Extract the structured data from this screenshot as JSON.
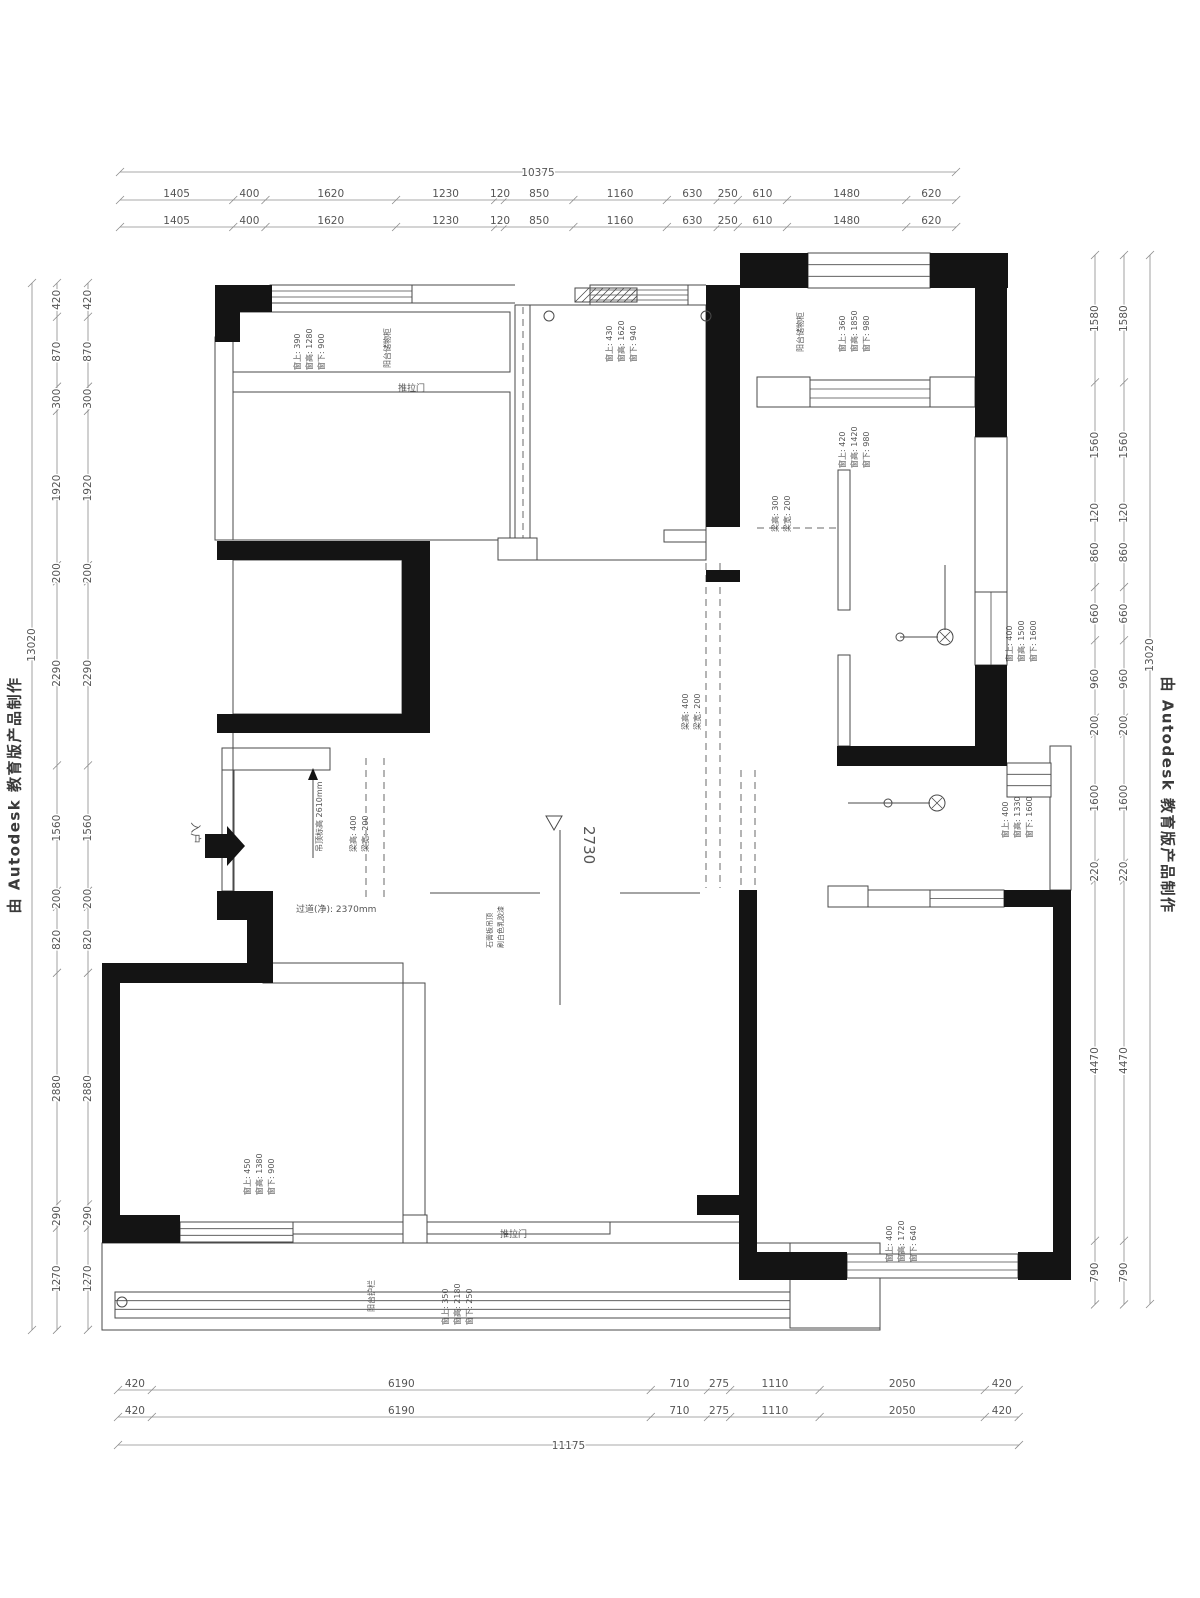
{
  "watermark": {
    "text": "由 Autodesk 教育版产品制作"
  },
  "dims": {
    "top": {
      "overall": "10375",
      "values": [
        "1405",
        "400",
        "1620",
        "1230",
        "120",
        "850",
        "1160",
        "630",
        "250",
        "610",
        "1480",
        "620"
      ]
    },
    "bottom": {
      "overall": "11175",
      "values": [
        "420",
        "6190",
        "710",
        "275",
        "1110",
        "2050",
        "420"
      ]
    },
    "left": {
      "overall": "13020",
      "values": [
        "420",
        "870",
        "300",
        "1920",
        "200",
        "2290",
        "1560",
        "200",
        "820",
        "2880",
        "290",
        "1270"
      ]
    },
    "right": {
      "overall": "13020",
      "values": [
        "1580",
        "1560",
        "120",
        "860",
        "660",
        "960",
        "200",
        "1600",
        "220",
        "4470",
        "790"
      ]
    }
  },
  "annotations": [
    {
      "name": "window-note-1",
      "x": 300,
      "y": 370,
      "rot": -90,
      "size": 8,
      "lines": [
        "窗上: 390",
        "窗高: 1280",
        "窗下: 900"
      ]
    },
    {
      "name": "window-note-2",
      "x": 612,
      "y": 362,
      "rot": -90,
      "size": 8,
      "lines": [
        "窗上: 430",
        "窗高: 1620",
        "窗下: 940"
      ]
    },
    {
      "name": "window-note-3",
      "x": 845,
      "y": 352,
      "rot": -90,
      "size": 8,
      "lines": [
        "窗上: 360",
        "窗高: 1850",
        "窗下: 980"
      ]
    },
    {
      "name": "window-note-4",
      "x": 845,
      "y": 468,
      "rot": -90,
      "size": 8,
      "lines": [
        "窗上: 420",
        "窗高: 1420",
        "窗下: 980"
      ]
    },
    {
      "name": "window-note-5",
      "x": 1012,
      "y": 662,
      "rot": -90,
      "size": 8,
      "lines": [
        "窗上: 400",
        "窗高: 1500",
        "窗下: 1600"
      ]
    },
    {
      "name": "window-note-6",
      "x": 1008,
      "y": 838,
      "rot": -90,
      "size": 8,
      "lines": [
        "窗上: 400",
        "窗高: 1330",
        "窗下: 1600"
      ]
    },
    {
      "name": "window-note-7",
      "x": 250,
      "y": 1195,
      "rot": -90,
      "size": 8,
      "lines": [
        "窗上: 450",
        "窗高: 1380",
        "窗下: 900"
      ]
    },
    {
      "name": "window-note-8",
      "x": 448,
      "y": 1325,
      "rot": -90,
      "size": 8,
      "lines": [
        "窗上: 350",
        "窗高: 2180",
        "窗下: 250"
      ]
    },
    {
      "name": "window-note-9",
      "x": 892,
      "y": 1262,
      "rot": -90,
      "size": 8,
      "lines": [
        "窗上: 400",
        "窗高: 1720",
        "窗下: 640"
      ]
    },
    {
      "name": "beam-note-1",
      "x": 356,
      "y": 852,
      "rot": -90,
      "size": 8,
      "lines": [
        "梁高: 400",
        "梁宽: 200"
      ]
    },
    {
      "name": "beam-note-2",
      "x": 688,
      "y": 730,
      "rot": -90,
      "size": 8,
      "lines": [
        "梁高: 400",
        "梁宽: 200"
      ]
    },
    {
      "name": "beam-note-3",
      "x": 778,
      "y": 532,
      "rot": -90,
      "size": 8,
      "lines": [
        "梁高: 300",
        "梁宽: 200"
      ]
    },
    {
      "name": "cabinet-label-left",
      "x": 390,
      "y": 368,
      "rot": -90,
      "size": 8,
      "lines": [
        "阳台储物柜"
      ]
    },
    {
      "name": "cabinet-label-right",
      "x": 803,
      "y": 352,
      "rot": -90,
      "size": 8,
      "lines": [
        "阳台储物柜"
      ]
    },
    {
      "name": "balcony-label",
      "x": 374,
      "y": 1312,
      "rot": -90,
      "size": 8,
      "lines": [
        "阳台护栏"
      ]
    },
    {
      "name": "entry-label",
      "x": 192,
      "y": 822,
      "rot": 90,
      "size": 11,
      "lines": [
        "入户"
      ]
    },
    {
      "name": "corridor-width",
      "x": 296,
      "y": 912,
      "rot": 0,
      "size": 9,
      "lines": [
        "过道(净): 2370mm"
      ]
    },
    {
      "name": "ceiling-height-note",
      "x": 322,
      "y": 852,
      "rot": -90,
      "size": 8,
      "lines": [
        "吊顶标高 2610mm"
      ]
    },
    {
      "name": "ceiling-finish-note",
      "x": 492,
      "y": 948,
      "rot": -90,
      "size": 7,
      "lines": [
        "石膏板吊顶",
        "刷白色乳胶漆"
      ]
    },
    {
      "name": "elevation-value",
      "x": 584,
      "y": 826,
      "rot": 90,
      "size": 15,
      "lines": [
        "2730"
      ]
    },
    {
      "name": "sliding-door-top",
      "x": 398,
      "y": 391,
      "rot": 0,
      "size": 9,
      "lines": [
        "推拉门"
      ]
    },
    {
      "name": "sliding-door-bottom",
      "x": 500,
      "y": 1237,
      "rot": 0,
      "size": 9,
      "lines": [
        "推拉门"
      ]
    }
  ],
  "plan": {
    "walls_black": [
      [
        215,
        285,
        57,
        27
      ],
      [
        215,
        285,
        25,
        57
      ],
      [
        706,
        285,
        34,
        242
      ],
      [
        706,
        570,
        34,
        12
      ],
      [
        740,
        253,
        68,
        35
      ],
      [
        930,
        253,
        78,
        35
      ],
      [
        975,
        272,
        32,
        165
      ],
      [
        975,
        665,
        32,
        101
      ],
      [
        837,
        746,
        170,
        20
      ],
      [
        217,
        541,
        213,
        19
      ],
      [
        402,
        541,
        28,
        192
      ],
      [
        217,
        714,
        213,
        19
      ],
      [
        217,
        891,
        56,
        29
      ],
      [
        247,
        920,
        26,
        63
      ],
      [
        102,
        963,
        161,
        20
      ],
      [
        102,
        963,
        18,
        280
      ],
      [
        102,
        1215,
        78,
        28
      ],
      [
        697,
        1195,
        43,
        20
      ],
      [
        739,
        890,
        18,
        390
      ],
      [
        1004,
        890,
        67,
        17
      ],
      [
        1053,
        890,
        18,
        390
      ],
      [
        739,
        1252,
        108,
        28
      ],
      [
        1018,
        1252,
        53,
        28
      ]
    ],
    "walls_thin": [
      [
        215,
        337,
        18,
        203
      ],
      [
        233,
        312,
        277,
        60
      ],
      [
        233,
        392,
        277,
        148
      ],
      [
        515,
        305,
        15,
        255
      ],
      [
        530,
        305,
        176,
        255
      ],
      [
        233,
        560,
        169,
        154
      ],
      [
        222,
        748,
        108,
        22
      ],
      [
        222,
        770,
        12,
        121
      ],
      [
        757,
        377,
        53,
        30
      ],
      [
        930,
        377,
        45,
        30
      ],
      [
        838,
        470,
        12,
        140
      ],
      [
        838,
        655,
        12,
        91
      ],
      [
        975,
        437,
        32,
        155
      ],
      [
        1050,
        746,
        21,
        144
      ],
      [
        868,
        890,
        62,
        17
      ],
      [
        403,
        983,
        22,
        239
      ],
      [
        263,
        963,
        140,
        20
      ],
      [
        293,
        1222,
        317,
        12
      ],
      [
        102,
        1243,
        778,
        87
      ],
      [
        790,
        1243,
        90,
        85
      ]
    ],
    "lines": [
      [
        233,
        733,
        233,
        891
      ],
      [
        430,
        893,
        540,
        893
      ],
      [
        620,
        893,
        700,
        893
      ],
      [
        412,
        285,
        515,
        285
      ],
      [
        412,
        303,
        515,
        303
      ],
      [
        688,
        285,
        706,
        285
      ],
      [
        688,
        305,
        706,
        305
      ],
      [
        560,
        830,
        560,
        1005
      ],
      [
        610,
        1222,
        739,
        1222
      ],
      [
        945,
        565,
        945,
        630
      ],
      [
        900,
        637,
        938,
        637
      ],
      [
        848,
        803,
        930,
        803
      ],
      [
        313,
        778,
        313,
        858
      ]
    ],
    "dashed": [
      [
        523,
        307,
        523,
        545
      ],
      [
        366,
        758,
        366,
        898
      ],
      [
        384,
        758,
        384,
        898
      ],
      [
        706,
        563,
        706,
        888
      ],
      [
        720,
        563,
        720,
        888
      ],
      [
        757,
        528,
        838,
        528
      ],
      [
        741,
        770,
        741,
        888
      ],
      [
        755,
        770,
        755,
        888
      ]
    ],
    "windows": [
      [
        270,
        285,
        142,
        18,
        2
      ],
      [
        590,
        285,
        98,
        20,
        3
      ],
      [
        808,
        253,
        122,
        35,
        2
      ],
      [
        810,
        380,
        120,
        27,
        2
      ],
      [
        975,
        592,
        32,
        73,
        1
      ],
      [
        1007,
        763,
        44,
        34,
        2
      ],
      [
        930,
        890,
        74,
        17,
        1
      ],
      [
        847,
        1254,
        171,
        24,
        2
      ],
      [
        180,
        1222,
        113,
        20,
        2
      ],
      [
        115,
        1292,
        675,
        26,
        2
      ]
    ],
    "footings": [
      [
        498,
        538,
        39,
        22
      ],
      [
        828,
        886,
        40,
        21
      ],
      [
        403,
        1215,
        24,
        28
      ]
    ],
    "fixtures": [
      [
        945,
        637
      ],
      [
        937,
        803
      ]
    ],
    "rings": [
      [
        900,
        637,
        4
      ],
      [
        888,
        803,
        4
      ],
      [
        549,
        316,
        5
      ],
      [
        706,
        316,
        5
      ],
      [
        122,
        1302,
        5
      ]
    ],
    "hatch": [
      575,
      288,
      62,
      14
    ],
    "door_leaf": [
      664,
      530,
      42,
      12
    ],
    "entry_arrow": "205,834 227,834 227,826 245,846 227,866 227,858 205,858",
    "up_arrow_head": "308,780 318,780 313,768",
    "elevation_triangle": "546,816 562,816 554,830"
  }
}
